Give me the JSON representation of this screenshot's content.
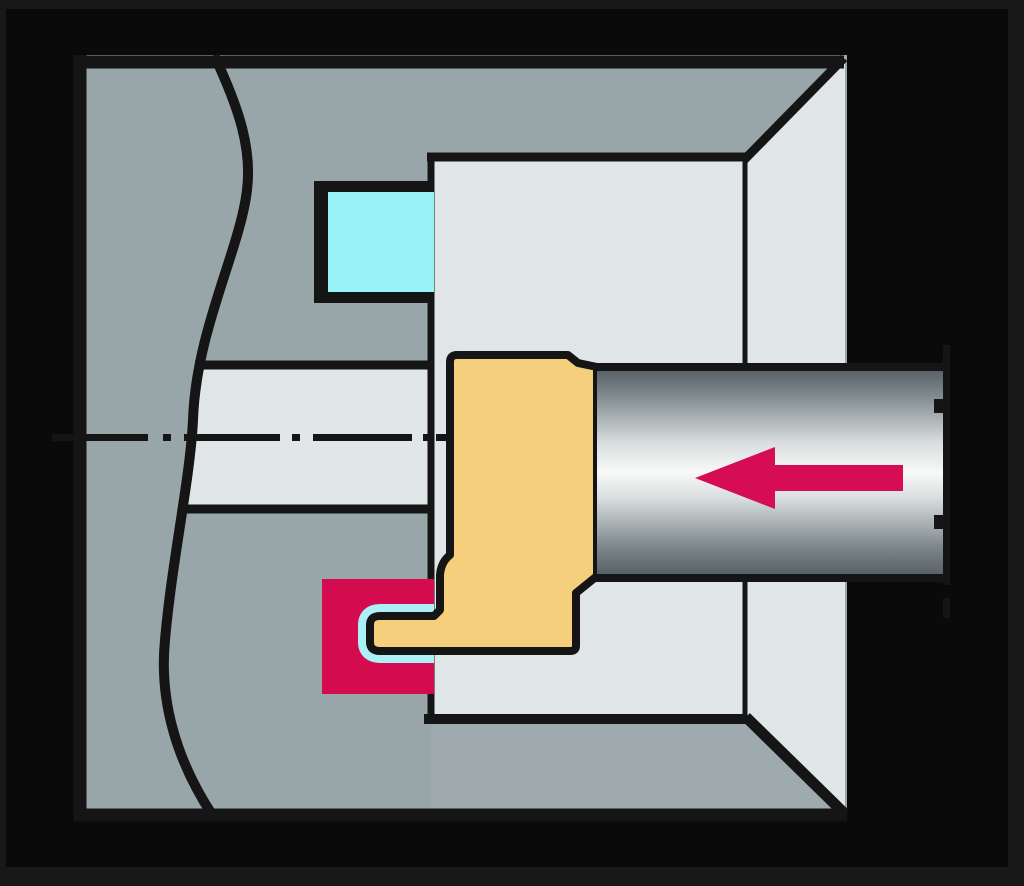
{
  "figure": {
    "type": "technical-cutaway-illustration",
    "subject": "Internal grooving operation inside a bored workpiece",
    "arrow_direction": "left",
    "text": ""
  },
  "colors": {
    "frame": "#181818",
    "background": "#0a0a0a",
    "line": "#151515",
    "face_gray": "#99A6A9",
    "interior_light": "#E0E5E7",
    "floor_gray": "#9EAAAD",
    "highlight_cyan": "#98F3F9",
    "clearance_cyan": "#ABEFF7",
    "groove_red": "#D50B50",
    "arrow_red": "#D60D53",
    "tool_tan": "#F6CF7D",
    "shank_dark": "#525C61",
    "shank_mid": "#7E888C",
    "shank_pale": "#D9DEDE",
    "shank_light": "#F8F9F9"
  },
  "parts": {
    "workpiece": "workpiece cross-section",
    "break_line": "wavy break line",
    "bore": "machined bore",
    "centerline": "dash-dot centerline",
    "recess_top": "machined recess (highlighted)",
    "groove_zone": "groove being cut (highlighted)",
    "clearance": "insert clearance (highlighted)",
    "tool_head": "grooving tool head with insert",
    "shank": "cylindrical tool shank",
    "shank_break": "shank break marks",
    "feed_arrow": "axial feed direction arrow"
  }
}
